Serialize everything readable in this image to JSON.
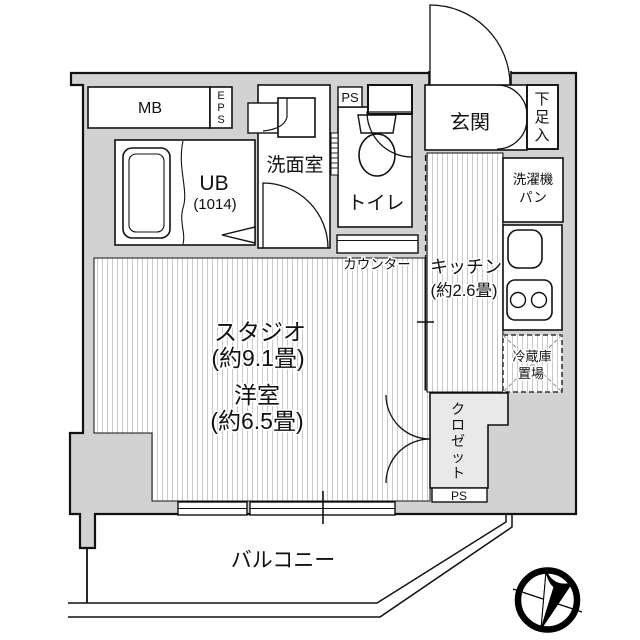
{
  "floorplan": {
    "type": "japanese-apartment-floorplan",
    "colors": {
      "wall_fill": "#d2d2d2",
      "line": "#111111",
      "floor_stripe": "#c9c9c9",
      "closet_fill": "#e9e9e9",
      "background": "#ffffff"
    },
    "labels": {
      "mb": "MB",
      "eps": "EPS",
      "eps_chars": [
        "E",
        "P",
        "S"
      ],
      "ps_top": "PS",
      "ps_bottom": "PS",
      "genkan": "玄関",
      "shoe": "下足入",
      "shoe_chars": [
        "下",
        "足",
        "入"
      ],
      "washroom": "洗面室",
      "toilet": "トイレ",
      "ub": "UB",
      "ub_size": "(1014)",
      "laundry_line1": "洗濯機",
      "laundry_line2": "パン",
      "kitchen": "キッチン",
      "kitchen_size": "(約2.6畳)",
      "counter": "カウンター",
      "studio": "スタジオ",
      "studio_size": "(約9.1畳)",
      "western_room": "洋室",
      "western_room_size": "(約6.5畳)",
      "fridge_line1": "冷蔵庫",
      "fridge_line2": "置場",
      "closet": "クロゼット",
      "closet_chars": [
        "ク",
        "ロ",
        "ゼ",
        "ッ",
        "ト"
      ],
      "balcony": "バルコニー"
    },
    "icons": {
      "compass": "north-compass-icon",
      "bathtub": "bathtub-icon",
      "toilet": "toilet-icon",
      "sink": "washbasin-icon",
      "stove": "two-burner-stove-icon",
      "kitchen_sink": "kitchen-sink-icon",
      "doors": "door-swing-arc-icon"
    }
  }
}
